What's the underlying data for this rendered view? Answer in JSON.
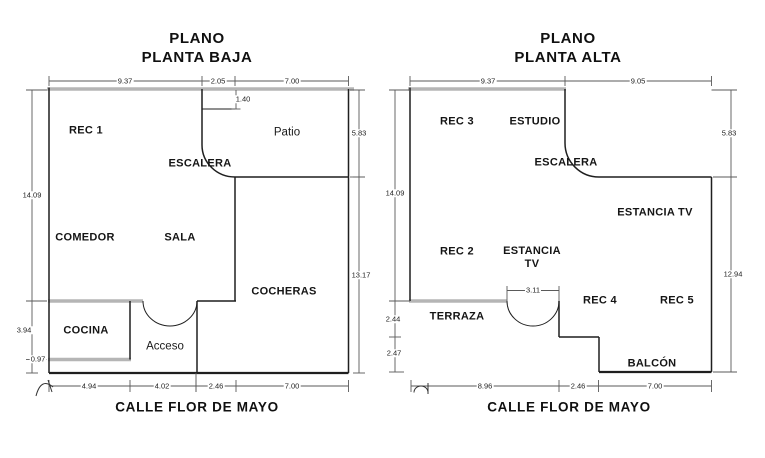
{
  "plans": [
    {
      "title": [
        "PLANO",
        "PLANTA BAJA"
      ],
      "street": "CALLE FLOR DE MAYO",
      "rooms": {
        "rec1": "REC 1",
        "patio": "Patio",
        "escalera": "ESCALERA",
        "comedor": "COMEDOR",
        "sala": "SALA",
        "cocheras": "COCHERAS",
        "cocina": "COCINA",
        "acceso": "Acceso"
      },
      "dims": {
        "top": [
          "9.37",
          "2.05",
          "7.00"
        ],
        "inner": [
          "1.40"
        ],
        "left": [
          "14.09",
          "3.94",
          "0.97"
        ],
        "right": [
          "5.83",
          "13.17"
        ],
        "bottom": [
          "4.94",
          "4.02",
          "2.46",
          "7.00"
        ]
      }
    },
    {
      "title": [
        "PLANO",
        "PLANTA ALTA"
      ],
      "street": "CALLE FLOR DE MAYO",
      "rooms": {
        "rec3": "REC 3",
        "estudio": "ESTUDIO",
        "escalera": "ESCALERA",
        "estancia_tv": "ESTANCIA TV",
        "rec2": "REC 2",
        "estancia_line1": "ESTANCIA",
        "estancia_line2": "TV",
        "terraza": "TERRAZA",
        "rec4": "REC 4",
        "rec5": "REC 5",
        "balcon": "BALCÓN"
      },
      "dims": {
        "top": [
          "9.37",
          "9.05"
        ],
        "inner": [
          "3.11"
        ],
        "left": [
          "14.09",
          "2.44",
          "2.47"
        ],
        "right": [
          "5.83",
          "12.94"
        ],
        "bottom": [
          "8.96",
          "2.46",
          "7.00"
        ]
      }
    }
  ],
  "colors": {
    "thick_wall": "#b5b5b5",
    "wall_line": "#1f1f1f",
    "dimension_line": "#5a5a5a",
    "text": "#111111",
    "background": "#ffffff"
  }
}
